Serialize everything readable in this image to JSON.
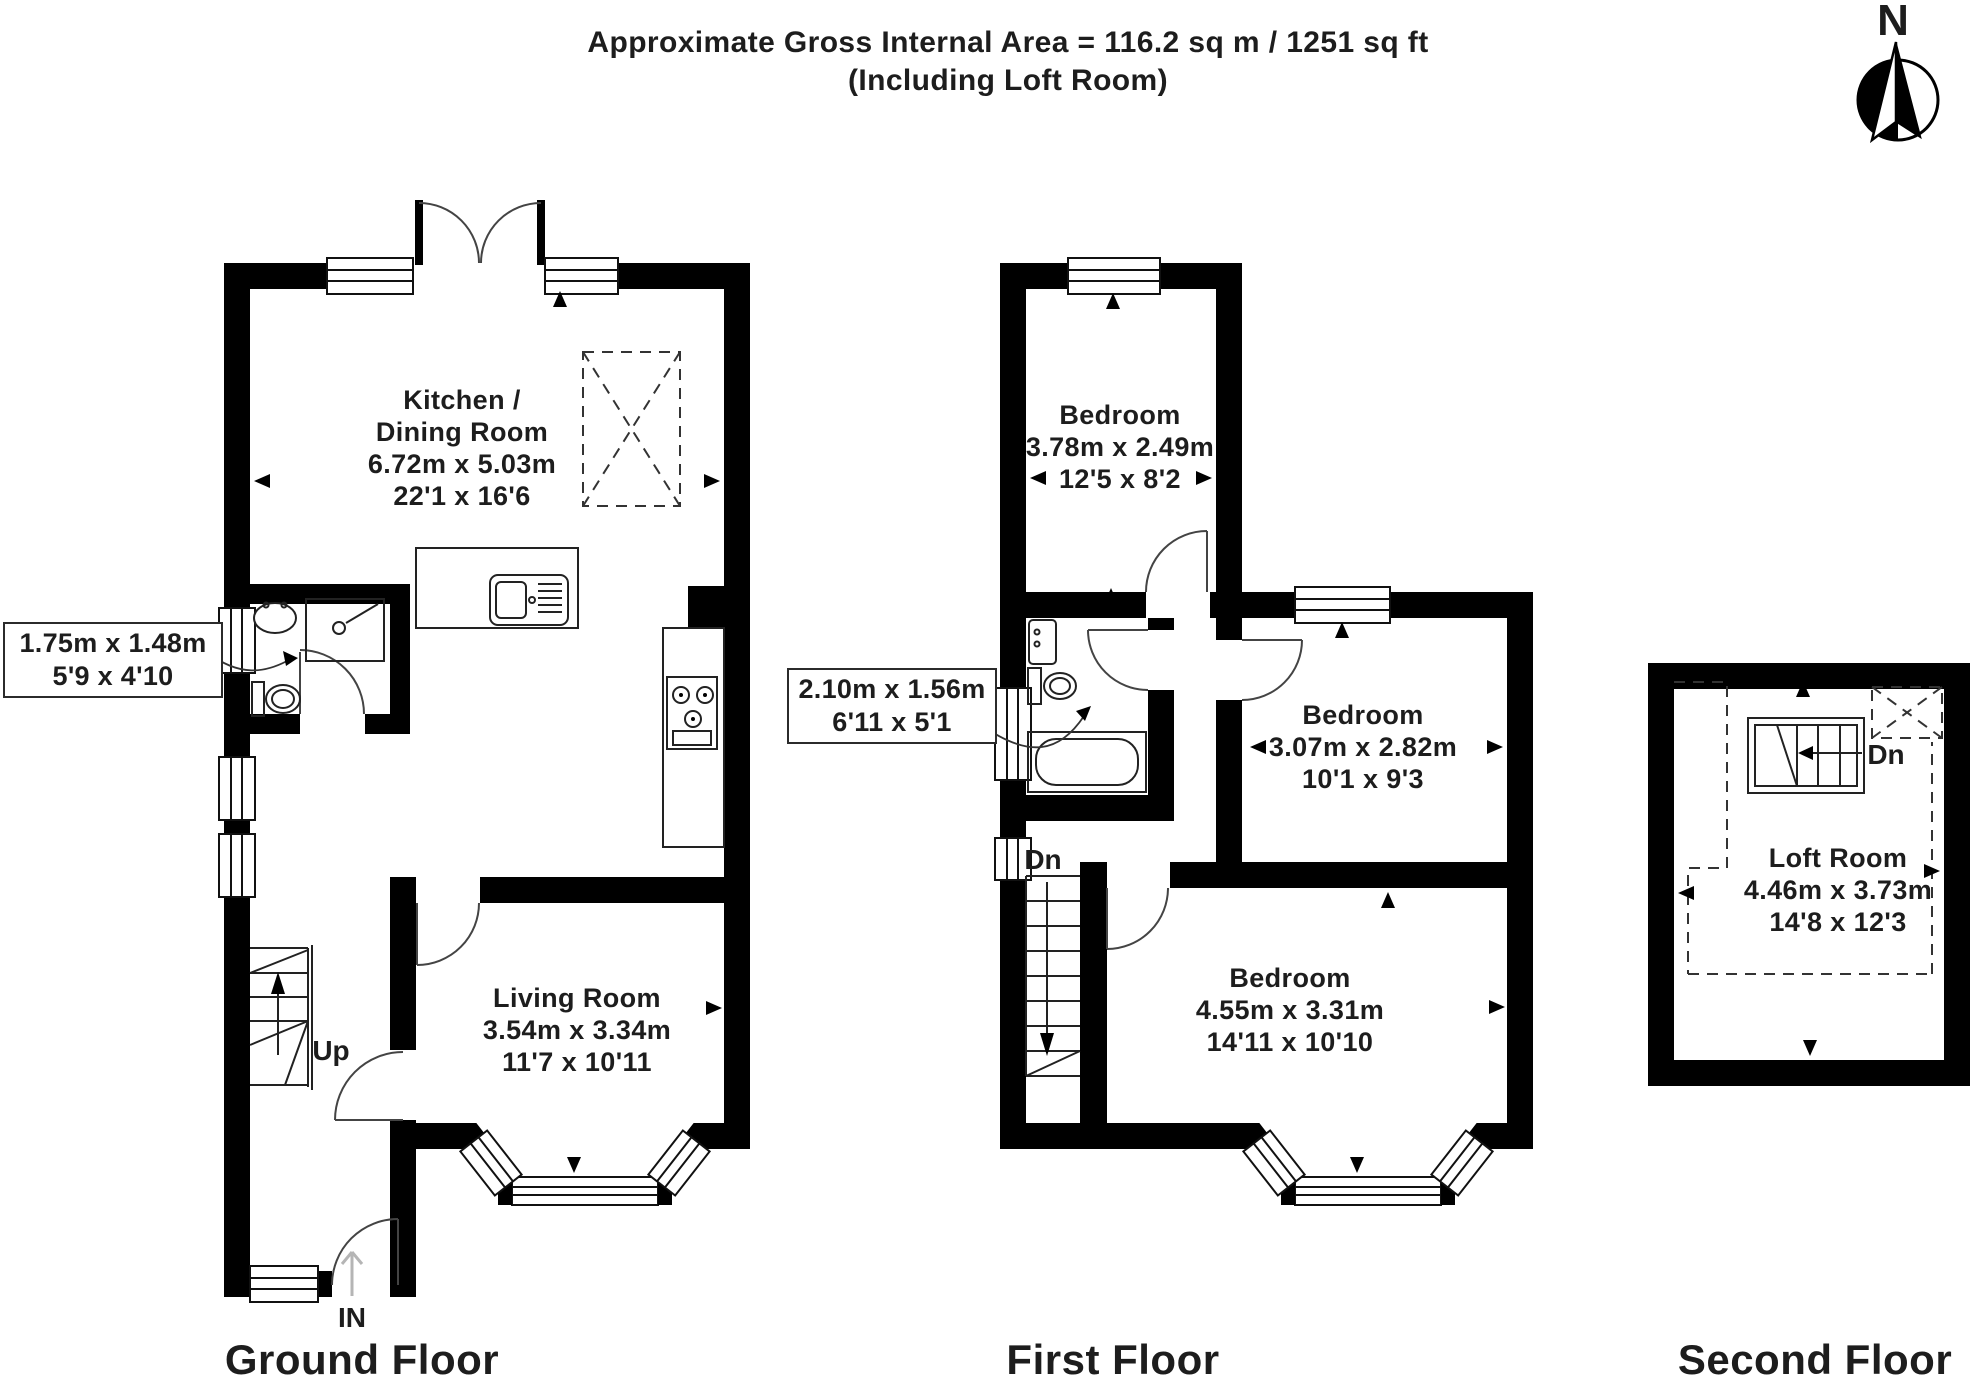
{
  "header": {
    "title_line1": "Approximate Gross Internal Area = 116.2 sq m / 1251 sq ft",
    "title_line2": "(Including Loft Room)",
    "north_label": "N"
  },
  "ground_floor": {
    "label": "Ground Floor",
    "kitchen": {
      "name_line1": "Kitchen /",
      "name_line2": "Dining Room",
      "size_metric": "6.72m x 5.03m",
      "size_imperial": "22'1 x 16'6"
    },
    "living_room": {
      "name": "Living Room",
      "size_metric": "3.54m x 3.34m",
      "size_imperial": "11'7 x 10'11"
    },
    "wc_callout": {
      "size_metric": "1.75m x 1.48m",
      "size_imperial": "5'9 x 4'10"
    },
    "stairs_label": "Up",
    "entrance_label": "IN"
  },
  "first_floor": {
    "label": "First Floor",
    "bedroom_1": {
      "name": "Bedroom",
      "size_metric": "3.78m x 2.49m",
      "size_imperial": "12'5 x 8'2"
    },
    "bathroom_callout": {
      "size_metric": "2.10m x 1.56m",
      "size_imperial": "6'11 x 5'1"
    },
    "bedroom_2": {
      "name": "Bedroom",
      "size_metric": "3.07m x 2.82m",
      "size_imperial": "10'1 x 9'3"
    },
    "bedroom_3": {
      "name": "Bedroom",
      "size_metric": "4.55m x 3.31m",
      "size_imperial": "14'11 x 10'10"
    },
    "stairs_label": "Dn"
  },
  "second_floor": {
    "label": "Second Floor",
    "loft_room": {
      "name": "Loft Room",
      "size_metric": "4.46m x 3.73m",
      "size_imperial": "14'8 x 12'3"
    },
    "stairs_label": "Dn"
  },
  "colors": {
    "wall": "#000000",
    "line": "#222222",
    "text": "#1d1d1d"
  }
}
